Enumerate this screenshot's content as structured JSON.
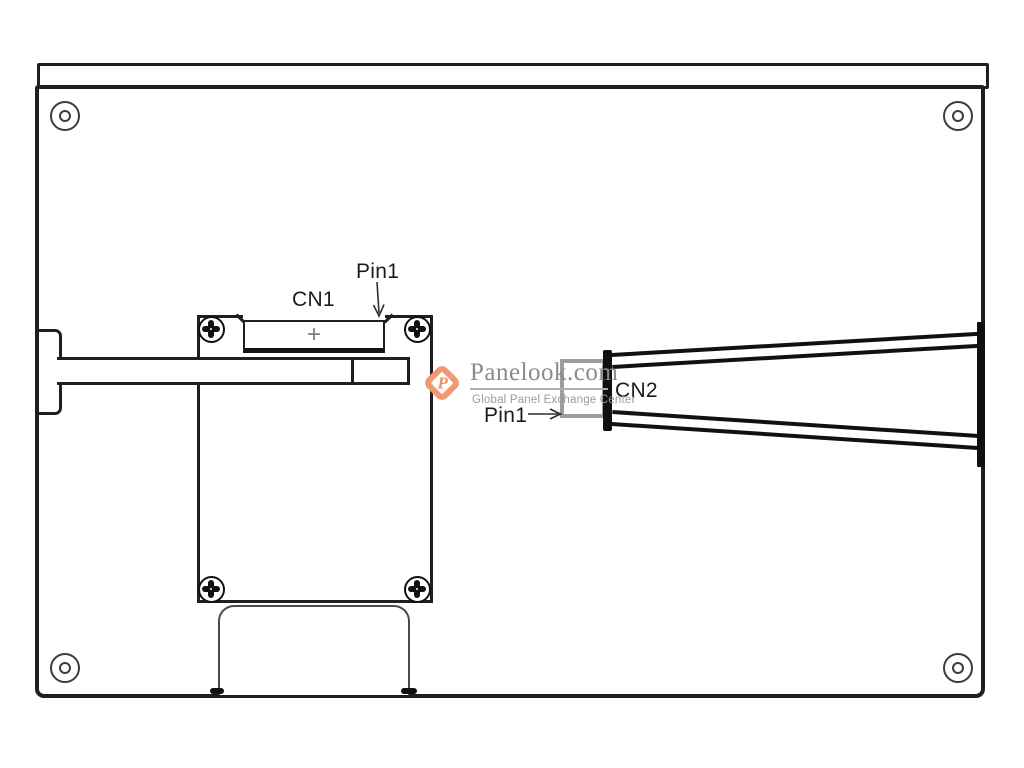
{
  "diagram": {
    "title": "LCD panel rear view outline drawing",
    "labels": {
      "cn1": "CN1",
      "pin1_top": "Pin1",
      "cn2": "CN2",
      "pin1_bottom": "Pin1",
      "cn1_marker": "+"
    },
    "watermark": {
      "logo_letter": "P",
      "title": "Panelook.com",
      "subtitle": "Global Panel Exchange Center",
      "accent_color": "#F0946B",
      "text_color": "#8B8B8B"
    },
    "colors": {
      "line": "#1F1F1F",
      "connector_gray": "#9D9D9D",
      "background": "#FFFFFF"
    }
  }
}
